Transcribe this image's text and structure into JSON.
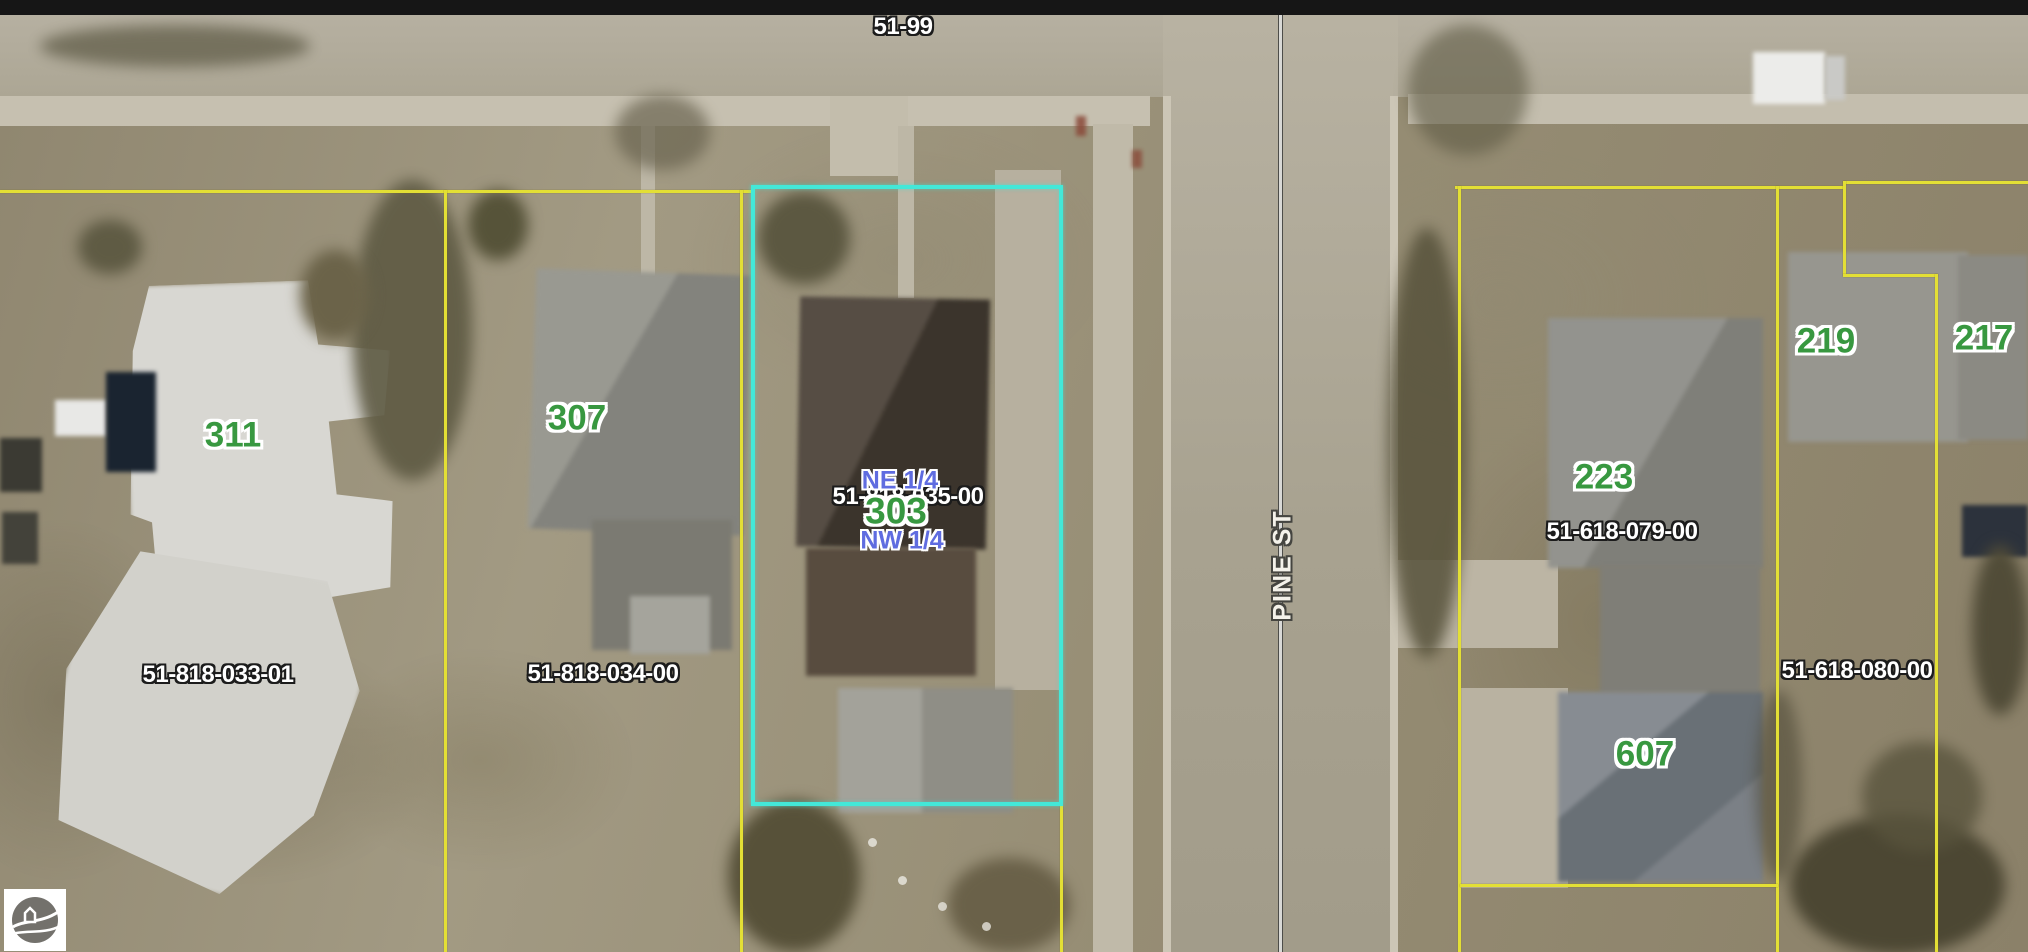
{
  "labels": {
    "section": "51-99",
    "street": "PINE ST",
    "quarters": {
      "ne": "NE 1/4",
      "nw": "NW 1/4"
    },
    "addresses": {
      "a311": "311",
      "a307": "307",
      "a303": "303",
      "a219": "219",
      "a217": "217",
      "a223": "223",
      "a607": "607"
    },
    "parcels": {
      "p033": "51-818-033-01",
      "p034": "51-818-034-00",
      "p035": "51-818-035-00",
      "p079": "51-618-079-00",
      "p080": "51-618-080-00"
    }
  },
  "colors": {
    "parcel_line": "#e3df35",
    "selected_parcel_outline": "#43e8d8",
    "address_text": "#389840",
    "quarter_text": "#5f6ce0",
    "parcel_text": "#ffffff",
    "street_text": "#f4f2ea",
    "top_bar": "#161616"
  },
  "logo": {
    "icon": "county-gis-logo"
  }
}
